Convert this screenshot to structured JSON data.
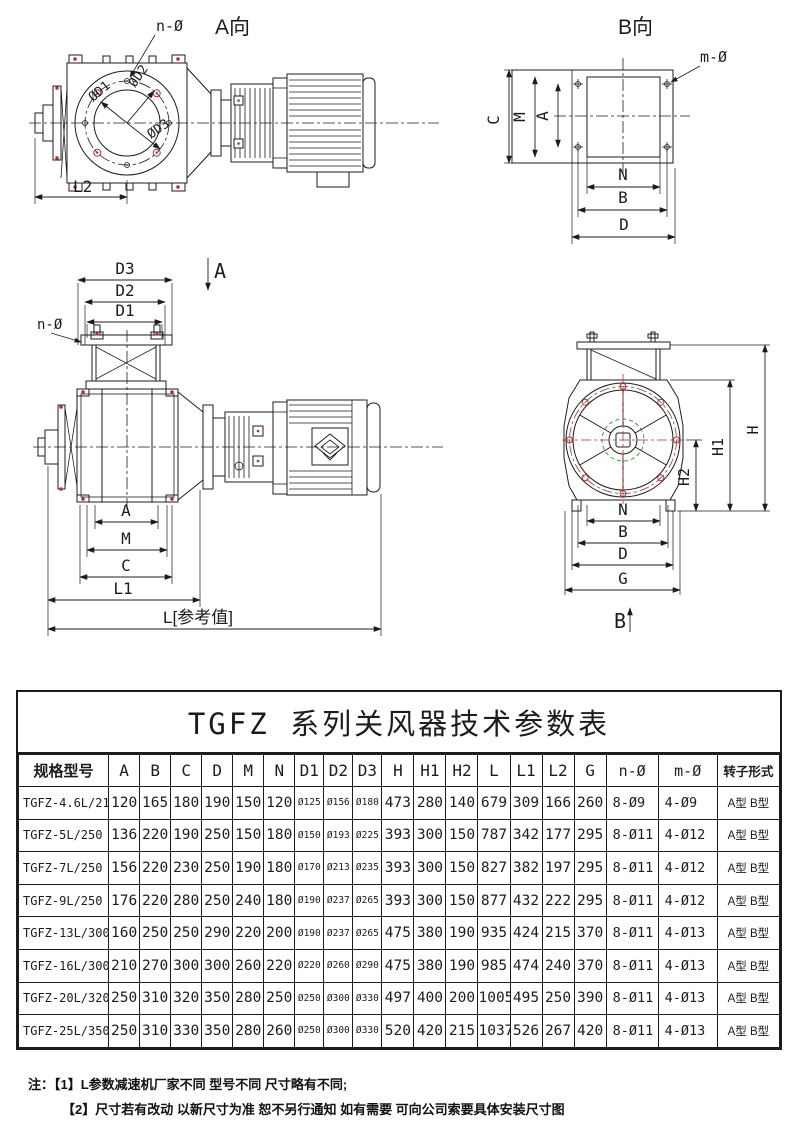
{
  "drawings": {
    "view_a": {
      "title": "A向",
      "bolt_callout": "n-Ø",
      "dia1": "ØD1",
      "dia2": "ØD2",
      "dia3": "ØD3",
      "dim_l2": "L2"
    },
    "view_b": {
      "title": "B向",
      "bolt_callout": "m-Ø",
      "dim_c": "C",
      "dim_m": "M",
      "dim_a": "A",
      "dim_n": "N",
      "dim_b": "B",
      "dim_d": "D"
    },
    "view_front": {
      "section_marker": "A",
      "bolt_callout": "n-Ø",
      "dim_d3": "D3",
      "dim_d2": "D2",
      "dim_d1": "D1",
      "dim_a": "A",
      "dim_m": "M",
      "dim_c": "C",
      "dim_l1": "L1",
      "dim_l_ref": "L[参考值]"
    },
    "view_side": {
      "section_marker": "B",
      "dim_h": "H",
      "dim_h1": "H1",
      "dim_h2": "H2",
      "dim_n": "N",
      "dim_b": "B",
      "dim_d": "D",
      "dim_g": "G"
    }
  },
  "table": {
    "title": "TGFZ 系列关风器技术参数表",
    "headers": [
      "规格型号",
      "A",
      "B",
      "C",
      "D",
      "M",
      "N",
      "D1",
      "D2",
      "D3",
      "H",
      "H1",
      "H2",
      "L",
      "L1",
      "L2",
      "G",
      "n-Ø",
      "m-Ø",
      "转子形式"
    ],
    "rows": [
      [
        "TGFZ-4.6L/210",
        "120",
        "165",
        "180",
        "190",
        "150",
        "120",
        "Ø125",
        "Ø156",
        "Ø180",
        "473",
        "280",
        "140",
        "679",
        "309",
        "166",
        "260",
        "8-Ø9",
        "4-Ø9",
        "A型 B型"
      ],
      [
        "TGFZ-5L/250",
        "136",
        "220",
        "190",
        "250",
        "150",
        "180",
        "Ø150",
        "Ø193",
        "Ø225",
        "393",
        "300",
        "150",
        "787",
        "342",
        "177",
        "295",
        "8-Ø11",
        "4-Ø12",
        "A型 B型"
      ],
      [
        "TGFZ-7L/250",
        "156",
        "220",
        "230",
        "250",
        "190",
        "180",
        "Ø170",
        "Ø213",
        "Ø235",
        "393",
        "300",
        "150",
        "827",
        "382",
        "197",
        "295",
        "8-Ø11",
        "4-Ø12",
        "A型 B型"
      ],
      [
        "TGFZ-9L/250",
        "176",
        "220",
        "280",
        "250",
        "240",
        "180",
        "Ø190",
        "Ø237",
        "Ø265",
        "393",
        "300",
        "150",
        "877",
        "432",
        "222",
        "295",
        "8-Ø11",
        "4-Ø12",
        "A型 B型"
      ],
      [
        "TGFZ-13L/300",
        "160",
        "250",
        "250",
        "290",
        "220",
        "200",
        "Ø190",
        "Ø237",
        "Ø265",
        "475",
        "380",
        "190",
        "935",
        "424",
        "215",
        "370",
        "8-Ø11",
        "4-Ø13",
        "A型 B型"
      ],
      [
        "TGFZ-16L/300",
        "210",
        "270",
        "300",
        "300",
        "260",
        "220",
        "Ø220",
        "Ø260",
        "Ø290",
        "475",
        "380",
        "190",
        "985",
        "474",
        "240",
        "370",
        "8-Ø11",
        "4-Ø13",
        "A型 B型"
      ],
      [
        "TGFZ-20L/320",
        "250",
        "310",
        "320",
        "350",
        "280",
        "250",
        "Ø250",
        "Ø300",
        "Ø330",
        "497",
        "400",
        "200",
        "1005",
        "495",
        "250",
        "390",
        "8-Ø11",
        "4-Ø13",
        "A型 B型"
      ],
      [
        "TGFZ-25L/350",
        "250",
        "310",
        "330",
        "350",
        "280",
        "260",
        "Ø250",
        "Ø300",
        "Ø330",
        "520",
        "420",
        "215",
        "1037",
        "526",
        "267",
        "420",
        "8-Ø11",
        "4-Ø13",
        "A型 B型"
      ]
    ]
  },
  "notes": {
    "label": "注：",
    "line1": "【1】L参数减速机厂家不同 型号不同 尺寸略有不同;",
    "line2": "【2】尺寸若有改动 以新尺寸为准 恕不另行通知 如有需要 可向公司索要具体安装尺寸图"
  },
  "colors": {
    "ink": "#1c1c1c",
    "accent_red": "#b23030",
    "accent_green": "#2d8f2d"
  }
}
